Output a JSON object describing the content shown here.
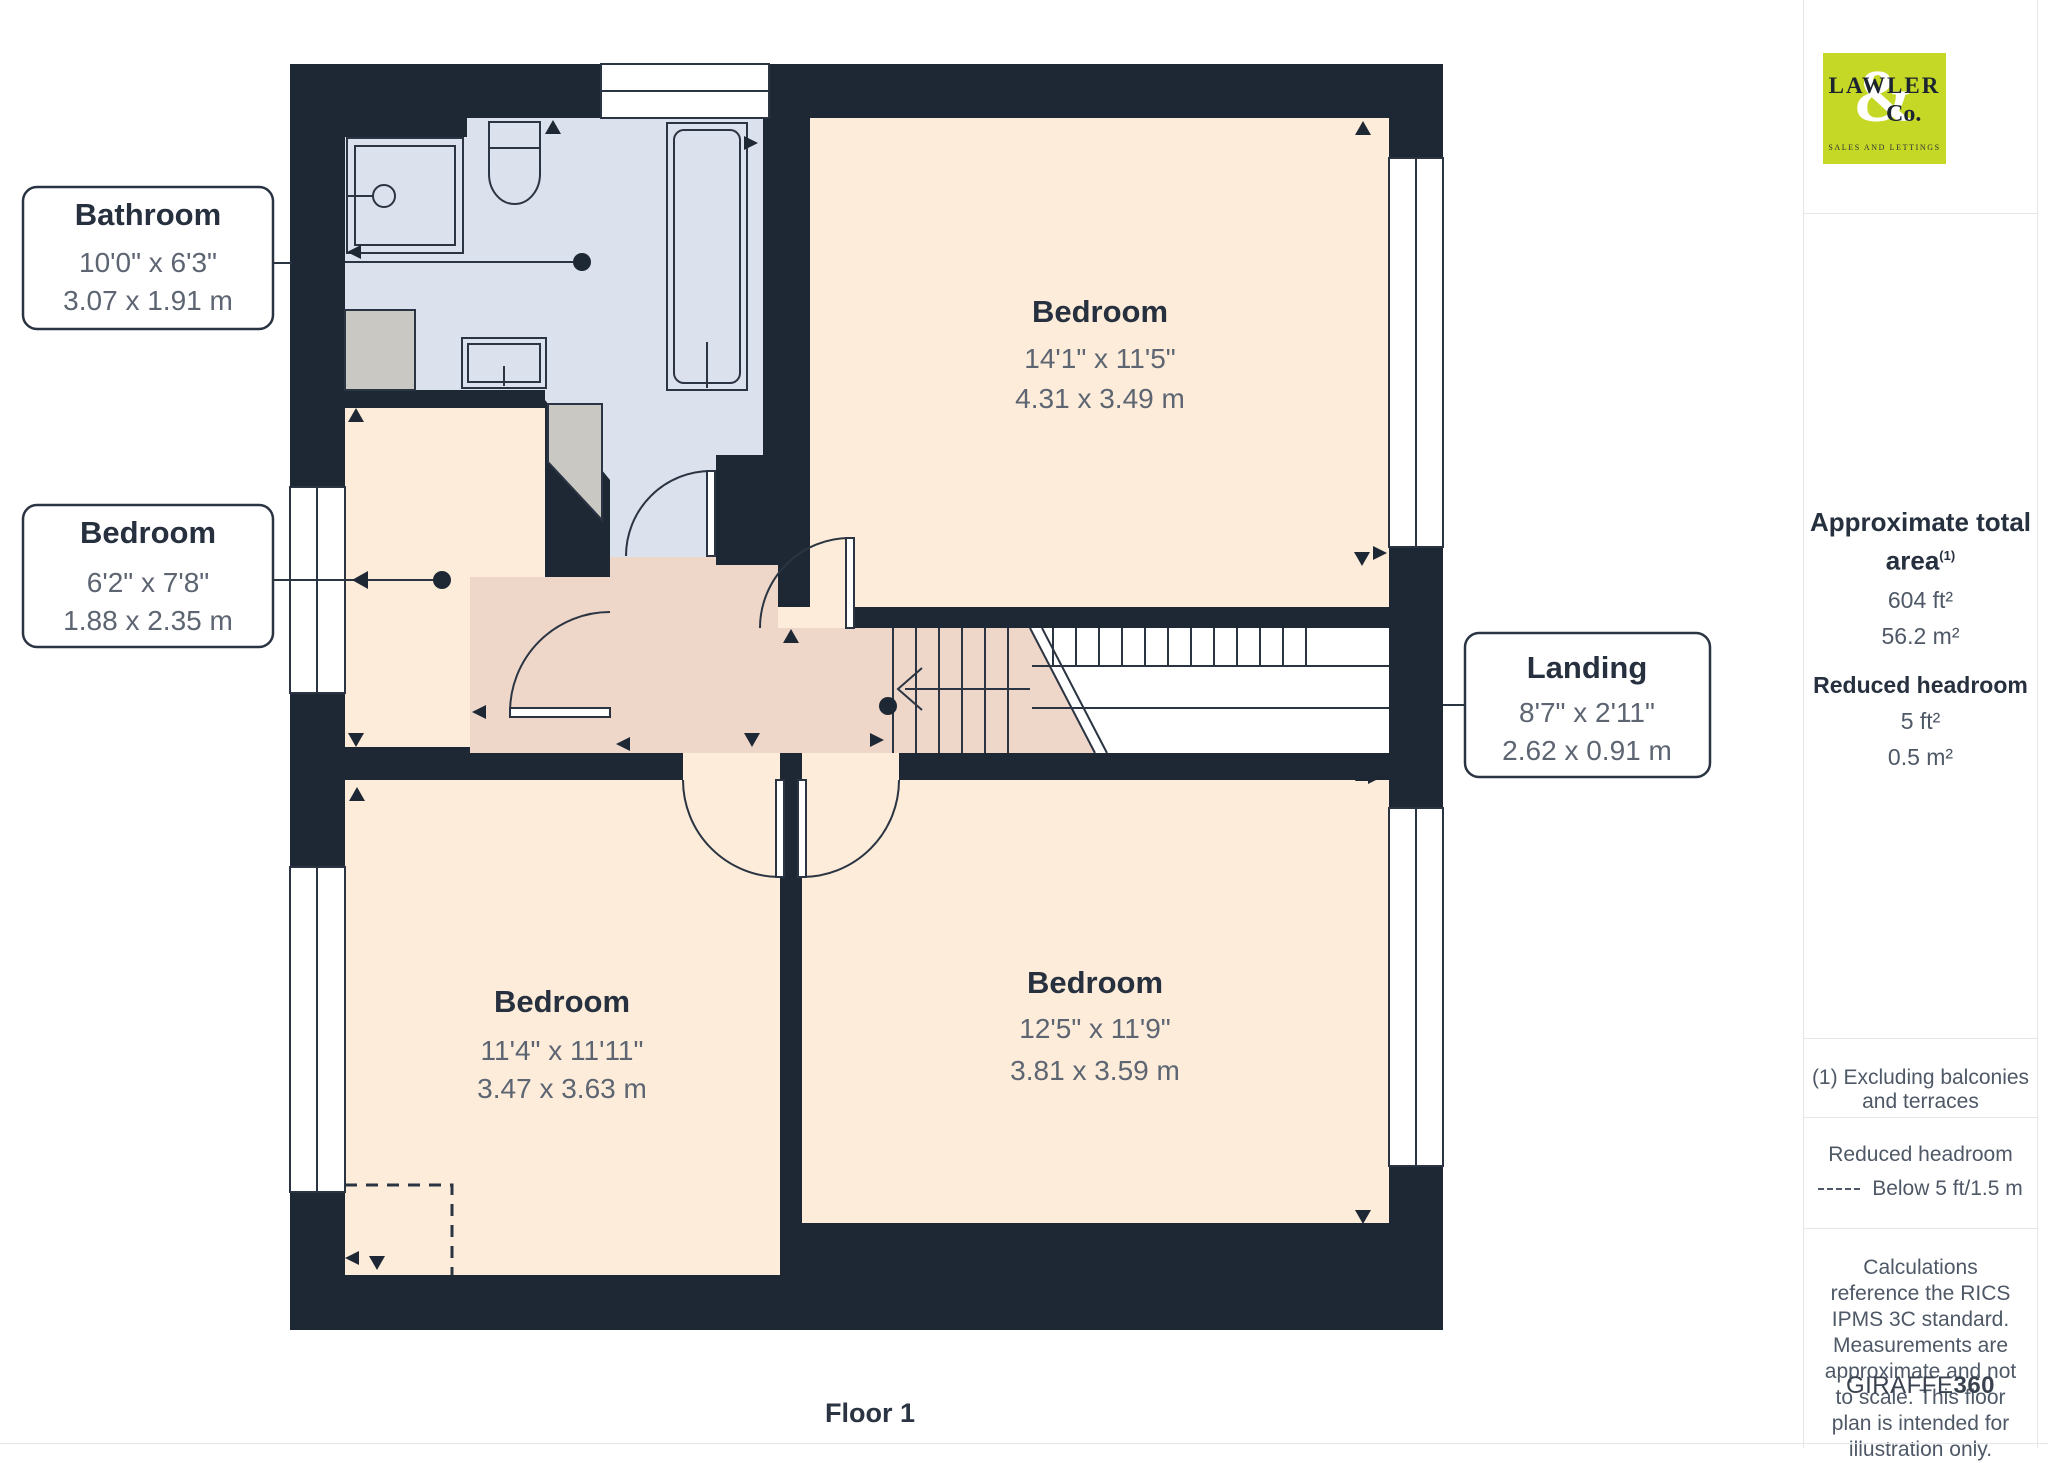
{
  "branding": {
    "logo_line1": "LAWLER",
    "logo_amp": "&",
    "logo_co": "Co.",
    "logo_tagline": "SALES AND LETTINGS"
  },
  "sidebar": {
    "total_area_label": "Approximate total area",
    "total_area_footnote": "(1)",
    "total_area_ft": "604 ft²",
    "total_area_m": "56.2 m²",
    "reduced_headroom_label": "Reduced headroom",
    "reduced_headroom_ft": "5 ft²",
    "reduced_headroom_m": "0.5 m²",
    "footnote": "(1) Excluding balconies and terraces",
    "legend_title": "Reduced headroom",
    "legend_label": "Below 5 ft/1.5 m",
    "disclaimer": "Calculations reference the RICS IPMS 3C standard. Measurements are approximate and not to scale. This floor plan is intended for illustration only.",
    "brand_name": "GIRAFFE",
    "brand_suffix": "360"
  },
  "floor": {
    "label": "Floor 1"
  },
  "rooms": {
    "bathroom": {
      "name": "Bathroom",
      "imperial": "10'0\" x 6'3\"",
      "metric": "3.07 x 1.91 m"
    },
    "bedroom_small": {
      "name": "Bedroom",
      "imperial": "6'2\" x 7'8\"",
      "metric": "1.88 x 2.35 m"
    },
    "landing": {
      "name": "Landing",
      "imperial": "8'7\" x 2'11\"",
      "metric": "2.62 x 0.91 m"
    },
    "bedroom_top": {
      "name": "Bedroom",
      "imperial": "14'1\" x 11'5\"",
      "metric": "4.31 x 3.49 m"
    },
    "bedroom_bottom_left": {
      "name": "Bedroom",
      "imperial": "11'4\" x 11'11\"",
      "metric": "3.47 x 3.63 m"
    },
    "bedroom_bottom_right": {
      "name": "Bedroom",
      "imperial": "12'5\" x 11'9\"",
      "metric": "3.81 x 3.59 m"
    }
  },
  "colors": {
    "wall": "#1e2734",
    "room_peach": "#fcecd9",
    "landing_pink": "#eed7c9",
    "bathroom_blue": "#dce1ee",
    "closet_gray": "#cac8c2",
    "logo_green": "#c6d826",
    "line_dark": "#2b3442",
    "text_dark": "#27303e",
    "text_dim": "#5d6572"
  }
}
